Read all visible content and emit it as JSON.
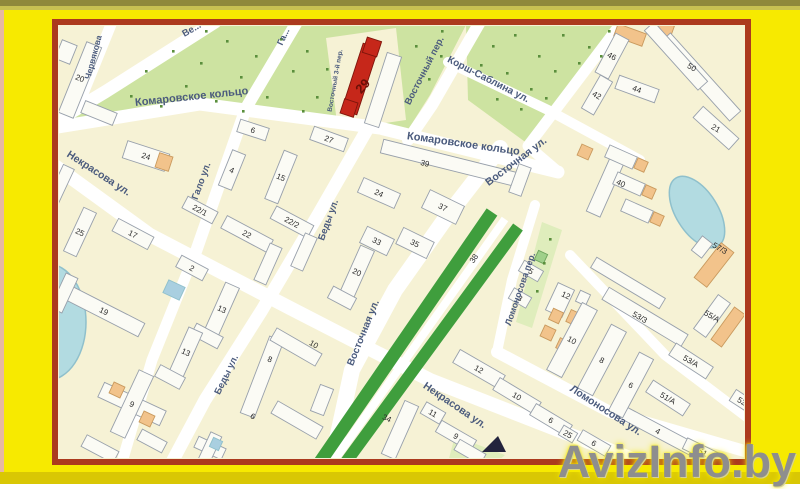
{
  "watermark": {
    "text": "AvizInfo.by"
  },
  "palette": {
    "page_bg": "#f7ea00",
    "top_band_dark": "#8f883b",
    "top_band_light": "#c8c052",
    "bottom_band": "#d9c704",
    "left_strip": "#e7b8a2",
    "border": "#ac3a1e",
    "map_bg": "#f6f2d5",
    "street": "#ffffff",
    "park": "#cde3a1",
    "park_light": "#dfedbc",
    "boulevard": "#3f9e3d",
    "park_dot": "#5a8f3c",
    "water": "#b2dbe1",
    "water_stroke": "#8fc0cc",
    "building": "#fbfbf5",
    "building_stroke": "#98a0ab",
    "orange": "#f2c38b",
    "orange_stroke": "#c99a5e",
    "blue_bldg": "#a9cfe0",
    "green_bldg": "#9fd08a",
    "red": "#c6271a",
    "red_stroke": "#7e150b",
    "street_label": "#4b5b7d",
    "num_label": "#2b2b2b",
    "highlight_label": "#6b1006",
    "marker": "#23233d",
    "watermark": "#8e8e8e"
  },
  "map": {
    "street_labels": [
      {
        "t": "Ве...",
        "x": 193,
        "y": 32,
        "r": -30,
        "s": 9.5
      },
      {
        "t": "Червякова",
        "x": 96,
        "y": 58,
        "r": -75,
        "s": 8.5
      },
      {
        "t": "Га...",
        "x": 286,
        "y": 38,
        "r": -65,
        "s": 9
      },
      {
        "t": "Комаровское кольцо",
        "x": 192,
        "y": 100,
        "r": -6,
        "s": 11
      },
      {
        "t": "Комаровское кольцо",
        "x": 463,
        "y": 147,
        "r": 8,
        "s": 11
      },
      {
        "t": "Некрасова ул.",
        "x": 97,
        "y": 176,
        "r": 33,
        "s": 10.5
      },
      {
        "t": "Некрасова ул.",
        "x": 453,
        "y": 408,
        "r": 34,
        "s": 10.5
      },
      {
        "t": "Гало ул.",
        "x": 204,
        "y": 182,
        "r": -70,
        "s": 9.5
      },
      {
        "t": "Беды ул.",
        "x": 331,
        "y": 221,
        "r": -70,
        "s": 9.5
      },
      {
        "t": "Беды ул.",
        "x": 229,
        "y": 376,
        "r": -64,
        "s": 9.5
      },
      {
        "t": "Восточный пер.",
        "x": 427,
        "y": 72,
        "r": -63,
        "s": 9.5
      },
      {
        "t": "Восточный 3-й пер.",
        "x": 337,
        "y": 81,
        "r": -80,
        "s": 6.5
      },
      {
        "t": "Корш-Саблина ул.",
        "x": 487,
        "y": 82,
        "r": 27,
        "s": 10
      },
      {
        "t": "Восточная ул.",
        "x": 518,
        "y": 164,
        "r": -37,
        "s": 10.5
      },
      {
        "t": "Восточная ул.",
        "x": 366,
        "y": 334,
        "r": -68,
        "s": 10
      },
      {
        "t": "Ломоносова ул.",
        "x": 604,
        "y": 413,
        "r": 33,
        "s": 10.5
      },
      {
        "t": "Ломоносова пер.",
        "x": 523,
        "y": 290,
        "r": -71,
        "s": 9
      },
      {
        "t": "38",
        "x": 476,
        "y": 260,
        "r": -55,
        "s": 8,
        "c": "num"
      }
    ],
    "highlight_label": {
      "t": "29",
      "x": 366,
      "y": 89,
      "r": -48,
      "s": 13
    },
    "buildings": [
      {
        "n": "20",
        "x": 80,
        "y": 80,
        "w": 16,
        "h": 76,
        "r": 22,
        "ly": -2
      },
      {
        "n": "",
        "x": 99,
        "y": 113,
        "w": 34,
        "h": 13,
        "r": 22
      },
      {
        "n": "",
        "x": 66,
        "y": 52,
        "w": 16,
        "h": 20,
        "r": 22
      },
      {
        "n": "24",
        "x": 146,
        "y": 156,
        "w": 44,
        "h": 18,
        "r": 18
      },
      {
        "n": "",
        "x": 164,
        "y": 162,
        "w": 14,
        "h": 15,
        "r": 18,
        "f": "o"
      },
      {
        "n": "",
        "x": 60,
        "y": 186,
        "w": 12,
        "h": 42,
        "r": 25
      },
      {
        "n": "25",
        "x": 80,
        "y": 232,
        "w": 14,
        "h": 48,
        "r": 25
      },
      {
        "n": "17",
        "x": 133,
        "y": 234,
        "w": 40,
        "h": 14,
        "r": 28
      },
      {
        "n": "2",
        "x": 192,
        "y": 268,
        "w": 30,
        "h": 13,
        "r": 28
      },
      {
        "n": "19",
        "x": 104,
        "y": 311,
        "w": 84,
        "h": 15,
        "r": 27
      },
      {
        "n": "",
        "x": 64,
        "y": 293,
        "w": 13,
        "h": 38,
        "r": 25
      },
      {
        "n": "13",
        "x": 222,
        "y": 309,
        "w": 15,
        "h": 52,
        "r": 24
      },
      {
        "n": "",
        "x": 207,
        "y": 336,
        "w": 30,
        "h": 13,
        "r": 28
      },
      {
        "n": "13",
        "x": 186,
        "y": 352,
        "w": 15,
        "h": 48,
        "r": 24
      },
      {
        "n": "",
        "x": 170,
        "y": 377,
        "w": 28,
        "h": 13,
        "r": 28
      },
      {
        "n": "9",
        "x": 132,
        "y": 404,
        "w": 68,
        "h": 16,
        "r": 25
      },
      {
        "n": "",
        "x": 132,
        "y": 404,
        "w": 16,
        "h": 68,
        "r": 25
      },
      {
        "n": "",
        "x": 117,
        "y": 390,
        "w": 12,
        "h": 12,
        "r": 25,
        "f": "o"
      },
      {
        "n": "",
        "x": 147,
        "y": 419,
        "w": 12,
        "h": 12,
        "r": 25,
        "f": "o"
      },
      {
        "n": "",
        "x": 100,
        "y": 449,
        "w": 36,
        "h": 13,
        "r": 28
      },
      {
        "n": "",
        "x": 152,
        "y": 441,
        "w": 28,
        "h": 12,
        "r": 28
      },
      {
        "n": "",
        "x": 210,
        "y": 448,
        "w": 30,
        "h": 12,
        "r": 25
      },
      {
        "n": "",
        "x": 210,
        "y": 448,
        "w": 12,
        "h": 30,
        "r": 25
      },
      {
        "n": "",
        "x": 216,
        "y": 444,
        "w": 10,
        "h": 10,
        "r": 25,
        "f": "b"
      },
      {
        "n": "",
        "x": 174,
        "y": 290,
        "w": 18,
        "h": 14,
        "r": 25,
        "f": "b"
      },
      {
        "n": "20",
        "x": 357,
        "y": 272,
        "w": 15,
        "h": 52,
        "r": 24
      },
      {
        "n": "",
        "x": 342,
        "y": 298,
        "w": 26,
        "h": 13,
        "r": 28
      },
      {
        "n": "6",
        "x": 253,
        "y": 130,
        "w": 30,
        "h": 13,
        "r": 18
      },
      {
        "n": "27",
        "x": 329,
        "y": 139,
        "w": 36,
        "h": 14,
        "r": 20
      },
      {
        "n": "4",
        "x": 232,
        "y": 170,
        "w": 14,
        "h": 38,
        "r": 22
      },
      {
        "n": "15",
        "x": 281,
        "y": 177,
        "w": 14,
        "h": 52,
        "r": 22
      },
      {
        "n": "22/1",
        "x": 200,
        "y": 210,
        "w": 34,
        "h": 13,
        "r": 28
      },
      {
        "n": "22",
        "x": 247,
        "y": 234,
        "w": 52,
        "h": 14,
        "r": 28
      },
      {
        "n": "22/2",
        "x": 292,
        "y": 222,
        "w": 42,
        "h": 14,
        "r": 28
      },
      {
        "n": "",
        "x": 268,
        "y": 264,
        "w": 13,
        "h": 40,
        "r": 24
      },
      {
        "n": "",
        "x": 304,
        "y": 252,
        "w": 13,
        "h": 36,
        "r": 24
      },
      {
        "n": "",
        "x": 383,
        "y": 90,
        "w": 15,
        "h": 74,
        "r": 18
      },
      {
        "n": "",
        "x": 360,
        "y": 79,
        "w": 16,
        "h": 70,
        "r": 18,
        "f": "r"
      },
      {
        "n": "",
        "x": 372,
        "y": 47,
        "w": 15,
        "h": 16,
        "r": 18,
        "f": "r"
      },
      {
        "n": "",
        "x": 349,
        "y": 108,
        "w": 14,
        "h": 15,
        "r": 18,
        "f": "r"
      },
      {
        "n": "24",
        "x": 379,
        "y": 193,
        "w": 40,
        "h": 16,
        "r": 24
      },
      {
        "n": "39",
        "x": 450,
        "y": 163,
        "w": 140,
        "h": 14,
        "r": 14,
        "lx": -25
      },
      {
        "n": "",
        "x": 520,
        "y": 180,
        "w": 13,
        "h": 30,
        "r": 20
      },
      {
        "n": "37",
        "x": 443,
        "y": 207,
        "w": 38,
        "h": 20,
        "r": 26
      },
      {
        "n": "33",
        "x": 377,
        "y": 241,
        "w": 30,
        "h": 18,
        "r": 26
      },
      {
        "n": "35",
        "x": 415,
        "y": 243,
        "w": 34,
        "h": 18,
        "r": 26
      },
      {
        "n": "",
        "x": 630,
        "y": 35,
        "w": 30,
        "h": 13,
        "r": 20,
        "f": "o"
      },
      {
        "n": "",
        "x": 662,
        "y": 28,
        "w": 22,
        "h": 12,
        "r": 20,
        "f": "o"
      },
      {
        "n": "46",
        "x": 612,
        "y": 56,
        "w": 15,
        "h": 44,
        "r": 28
      },
      {
        "n": "44",
        "x": 637,
        "y": 89,
        "w": 42,
        "h": 14,
        "r": 20
      },
      {
        "n": "42",
        "x": 597,
        "y": 95,
        "w": 14,
        "h": 38,
        "r": 30
      },
      {
        "n": "50",
        "x": 700,
        "y": 77,
        "w": 105,
        "h": 15,
        "r": 48,
        "lx": -8,
        "ly": -10
      },
      {
        "n": "",
        "x": 676,
        "y": 56,
        "w": 80,
        "h": 13,
        "r": 48
      },
      {
        "n": "21",
        "x": 716,
        "y": 128,
        "w": 48,
        "h": 15,
        "r": 42
      },
      {
        "n": "40",
        "x": 607,
        "y": 183,
        "w": 15,
        "h": 68,
        "r": 24,
        "lx": 14
      },
      {
        "n": "",
        "x": 621,
        "y": 157,
        "w": 30,
        "h": 13,
        "r": 24
      },
      {
        "n": "",
        "x": 629,
        "y": 184,
        "w": 30,
        "h": 13,
        "r": 24
      },
      {
        "n": "",
        "x": 637,
        "y": 211,
        "w": 30,
        "h": 13,
        "r": 24
      },
      {
        "n": "",
        "x": 641,
        "y": 165,
        "w": 11,
        "h": 11,
        "r": 24,
        "f": "o"
      },
      {
        "n": "",
        "x": 649,
        "y": 192,
        "w": 11,
        "h": 11,
        "r": 24,
        "f": "o"
      },
      {
        "n": "",
        "x": 657,
        "y": 219,
        "w": 11,
        "h": 11,
        "r": 24,
        "f": "o"
      },
      {
        "n": "",
        "x": 585,
        "y": 152,
        "w": 12,
        "h": 12,
        "r": 24,
        "f": "o"
      },
      {
        "n": "57/3",
        "x": 714,
        "y": 265,
        "w": 16,
        "h": 44,
        "r": 38,
        "f": "o",
        "lx": 6,
        "ly": -17
      },
      {
        "n": "",
        "x": 702,
        "y": 247,
        "w": 13,
        "h": 18,
        "r": 38
      },
      {
        "n": "",
        "x": 628,
        "y": 283,
        "w": 80,
        "h": 12,
        "r": 31
      },
      {
        "n": "53/3",
        "x": 645,
        "y": 317,
        "w": 92,
        "h": 14,
        "r": 31,
        "lx": -5
      },
      {
        "n": "55/A",
        "x": 712,
        "y": 316,
        "w": 15,
        "h": 42,
        "r": 36
      },
      {
        "n": "",
        "x": 728,
        "y": 327,
        "w": 13,
        "h": 40,
        "r": 36,
        "f": "o"
      },
      {
        "n": "53/A",
        "x": 691,
        "y": 361,
        "w": 44,
        "h": 14,
        "r": 33
      },
      {
        "n": "51/A",
        "x": 668,
        "y": 398,
        "w": 44,
        "h": 14,
        "r": 33
      },
      {
        "n": "52",
        "x": 742,
        "y": 401,
        "w": 22,
        "h": 13,
        "r": 33
      },
      {
        "n": "4",
        "x": 658,
        "y": 431,
        "w": 88,
        "h": 13,
        "r": 28
      },
      {
        "n": "51",
        "x": 703,
        "y": 452,
        "w": 40,
        "h": 12,
        "r": 26
      },
      {
        "n": "5",
        "x": 531,
        "y": 271,
        "w": 22,
        "h": 12,
        "r": 30
      },
      {
        "n": "3",
        "x": 520,
        "y": 298,
        "w": 20,
        "h": 12,
        "r": 30
      },
      {
        "n": "12",
        "x": 560,
        "y": 300,
        "w": 18,
        "h": 30,
        "r": 25,
        "lx": 6,
        "ly": -5
      },
      {
        "n": "",
        "x": 574,
        "y": 318,
        "w": 12,
        "h": 13,
        "r": 25,
        "f": "o"
      },
      {
        "n": "",
        "x": 556,
        "y": 316,
        "w": 11,
        "h": 12,
        "r": 25,
        "f": "o"
      },
      {
        "n": "",
        "x": 583,
        "y": 298,
        "w": 11,
        "h": 12,
        "r": 25
      },
      {
        "n": "",
        "x": 548,
        "y": 333,
        "w": 12,
        "h": 12,
        "r": 25,
        "f": "o"
      },
      {
        "n": "",
        "x": 563,
        "y": 345,
        "w": 11,
        "h": 11,
        "r": 25,
        "f": "o"
      },
      {
        "n": "",
        "x": 541,
        "y": 257,
        "w": 10,
        "h": 10,
        "r": 25,
        "f": "g"
      },
      {
        "n": "10",
        "x": 572,
        "y": 340,
        "w": 17,
        "h": 76,
        "r": 28
      },
      {
        "n": "8",
        "x": 602,
        "y": 360,
        "w": 17,
        "h": 72,
        "r": 28
      },
      {
        "n": "6",
        "x": 631,
        "y": 385,
        "w": 16,
        "h": 66,
        "r": 28
      },
      {
        "n": "12",
        "x": 479,
        "y": 369,
        "w": 52,
        "h": 15,
        "r": 30
      },
      {
        "n": "10",
        "x": 517,
        "y": 396,
        "w": 48,
        "h": 14,
        "r": 31
      },
      {
        "n": "6",
        "x": 551,
        "y": 420,
        "w": 42,
        "h": 13,
        "r": 31
      },
      {
        "n": "25",
        "x": 568,
        "y": 434,
        "w": 16,
        "h": 11,
        "r": 31
      },
      {
        "n": "6",
        "x": 594,
        "y": 443,
        "w": 32,
        "h": 12,
        "r": 30
      },
      {
        "n": "11",
        "x": 433,
        "y": 413,
        "w": 22,
        "h": 13,
        "r": 30
      },
      {
        "n": "9",
        "x": 456,
        "y": 436,
        "w": 40,
        "h": 13,
        "r": 30
      },
      {
        "n": "",
        "x": 470,
        "y": 452,
        "w": 30,
        "h": 12,
        "r": 30
      },
      {
        "n": "34",
        "x": 400,
        "y": 430,
        "w": 15,
        "h": 58,
        "r": 24,
        "lx": -13,
        "ly": -12
      },
      {
        "n": "8",
        "x": 262,
        "y": 377,
        "w": 15,
        "h": 82,
        "r": 21,
        "lx": 8,
        "ly": -18
      },
      {
        "n": "10",
        "x": 296,
        "y": 347,
        "w": 52,
        "h": 14,
        "r": 30,
        "lx": 18,
        "ly": -3
      },
      {
        "n": "6",
        "x": 297,
        "y": 420,
        "w": 52,
        "h": 14,
        "r": 30,
        "lx": -44,
        "ly": -4
      },
      {
        "n": "",
        "x": 322,
        "y": 400,
        "w": 14,
        "h": 28,
        "r": 21
      }
    ]
  }
}
